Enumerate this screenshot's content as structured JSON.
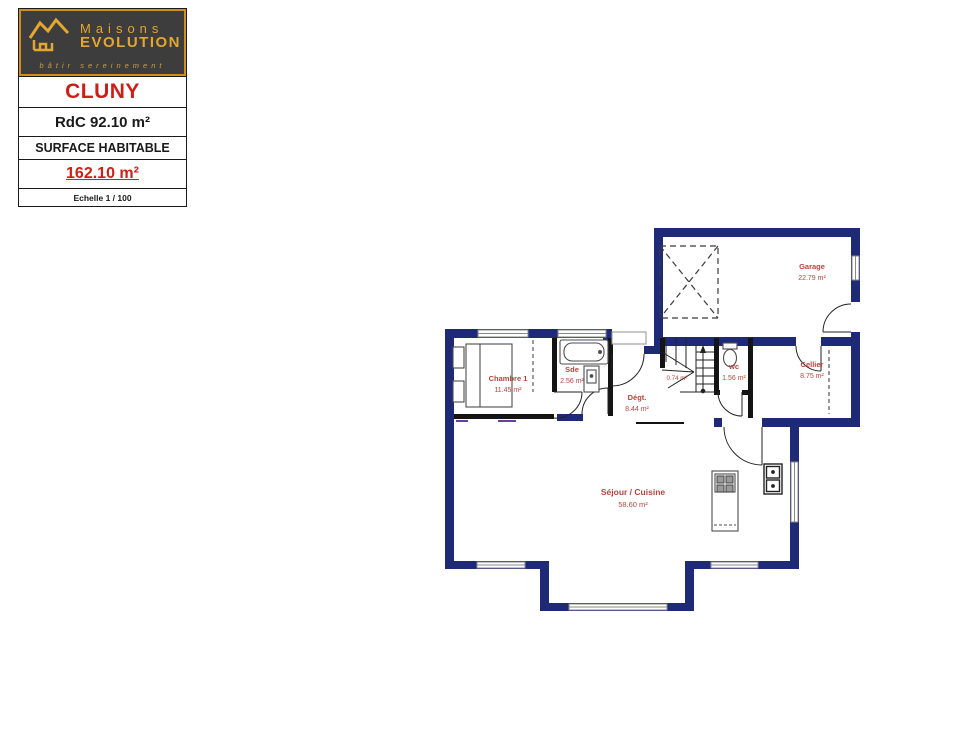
{
  "colors": {
    "wall_navy": "#1e2a75",
    "partition_black": "#141414",
    "accent_red": "#cc2017",
    "room_label_red": "#b5453e",
    "logo_gold": "#e3a62f",
    "logo_background": "#3d3d3d",
    "fixture_gray": "#4d4d4d",
    "tick_purple": "#6b3fa0"
  },
  "title_block": {
    "brand_line1": "Maisons",
    "brand_line2": "EVOLUTION",
    "tagline": "bâtir sereinement",
    "model": "CLUNY",
    "floor_area": "RdC 92.10 m²",
    "surface_label": "SURFACE HABITABLE",
    "surface_value": "162.10 m²",
    "scale": "Echelle 1 / 100"
  },
  "rooms": [
    {
      "name": "Garage",
      "area": "22.79 m²"
    },
    {
      "name": "Chambre 1",
      "area": "11.45 m²"
    },
    {
      "name": "Sde",
      "area": "2.56 m²"
    },
    {
      "name": "Dégt.",
      "area": "8.44 m²"
    },
    {
      "name": "",
      "area": "0.74 m²"
    },
    {
      "name": "wc",
      "area": "1.56 m²"
    },
    {
      "name": "Cellier",
      "area": "8.75 m²"
    },
    {
      "name": "Séjour / Cuisine",
      "area": "58.60 m²"
    }
  ]
}
